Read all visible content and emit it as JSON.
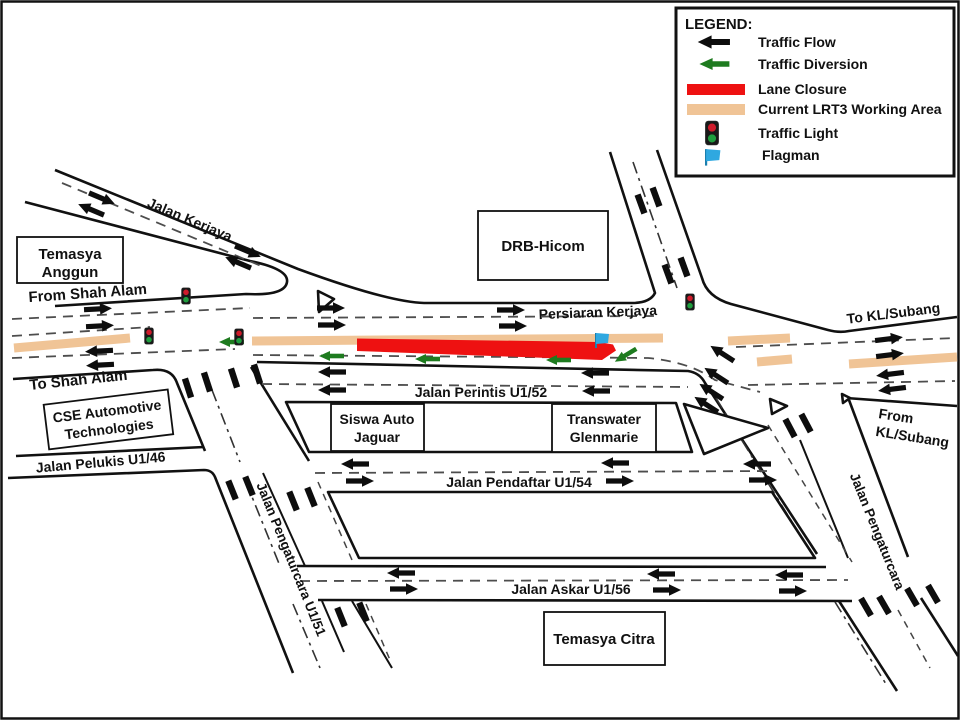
{
  "legend": {
    "title": "LEGEND:",
    "items": [
      {
        "key": "traffic-flow",
        "label": "Traffic Flow"
      },
      {
        "key": "traffic-diversion",
        "label": "Traffic Diversion"
      },
      {
        "key": "lane-closure",
        "label": "Lane Closure"
      },
      {
        "key": "lrt3-working-area",
        "label": "Current LRT3 Working Area"
      },
      {
        "key": "traffic-light",
        "label": "Traffic Light"
      },
      {
        "key": "flagman",
        "label": "Flagman"
      }
    ]
  },
  "roads": {
    "jalan_kerjaya": "Jalan Kerjaya",
    "persiaran_kerjaya": "Persiaran Kerjaya",
    "jalan_perintis": "Jalan Perintis U1/52",
    "jalan_pelukis": "Jalan Pelukis U1/46",
    "jalan_pendaftar": "Jalan Pendaftar U1/54",
    "jalan_askar": "Jalan Askar U1/56",
    "jalan_pengaturcara_u1_51": "Jalan Pengaturcara U1/51",
    "jalan_pengaturcara": "Jalan Pengaturcara"
  },
  "directions": {
    "from_shah_alam": "From Shah Alam",
    "to_shah_alam": "To Shah Alam",
    "to_kl_subang": "To KL/Subang",
    "from_kl_subang_line1": "From",
    "from_kl_subang_line2": "KL/Subang"
  },
  "places": {
    "temasya_anggun_line1": "Temasya",
    "temasya_anggun_line2": "Anggun",
    "drb_hicom": "DRB-Hicom",
    "cse_line1": "CSE Automotive",
    "cse_line2": "Technologies",
    "siswa_line1": "Siswa Auto",
    "siswa_line2": "Jaguar",
    "transwater_line1": "Transwater",
    "transwater_line2": "Glenmarie",
    "temasya_citra": "Temasya Citra"
  },
  "colors": {
    "traffic_flow": "#0d0d0d",
    "traffic_diversion": "#1e7b1f",
    "lane_closure": "#ee1111",
    "working_area": "#f0c496",
    "flagman_flag": "#2fa8e0",
    "light_red": "#cf1b2b",
    "light_green": "#1f9e3e"
  }
}
